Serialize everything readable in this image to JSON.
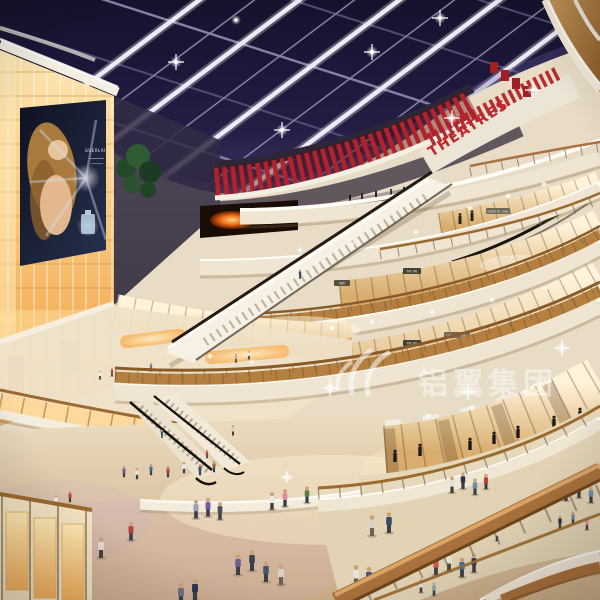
{
  "scene": {
    "description": "Night-time interior rendering of a multi-level shopping mall atrium with glass skylight, curved balconies, escalators and shoppers",
    "watermark_text": "铝翼集团",
    "signs": {
      "theatres": "THEATRES",
      "tai_tai": "TAI TAI",
      "cerruti": "CERRUTI 1881",
      "ajr": "AJR",
      "billboard_brand": "GUERLAIN"
    },
    "palette": {
      "skylight_navy": "#1b1736",
      "beam_white": "#eceaf4",
      "theatre_red": "#b2222a",
      "fascia_cream": "#efe5d2",
      "wood_rail": "#a8713d",
      "amber_glow": "#ffd79a",
      "store_warm": "#f6e7c4",
      "floor_beige": "#dcc6a4",
      "fire_orange": "#ff7517"
    }
  }
}
